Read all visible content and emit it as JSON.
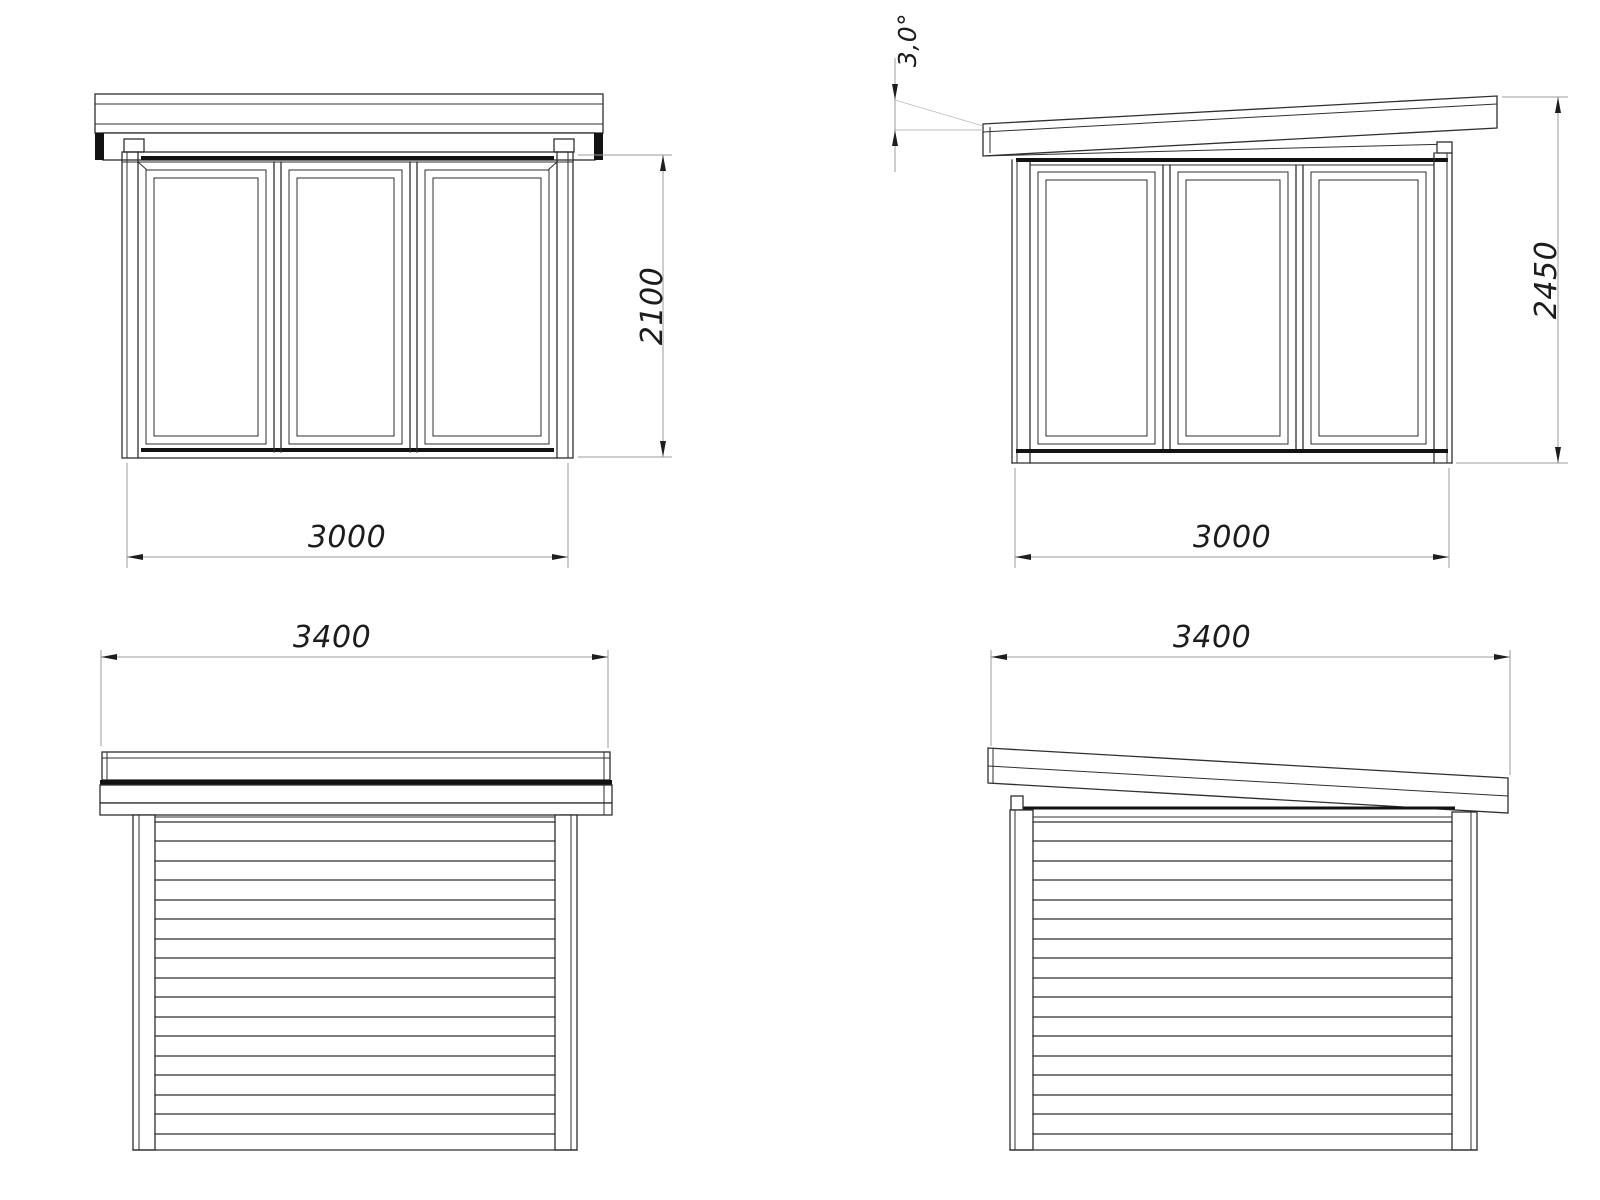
{
  "meta": {
    "background_color": "#ffffff",
    "line_color": "#2f2f2f",
    "heavy_line_color": "#121212",
    "dimension_line_color": "#9b9b9b",
    "dimension_text_color": "#1c1c1c"
  },
  "views": {
    "front_left": {
      "height_label": "2100",
      "width_label": "3000"
    },
    "front_right": {
      "angle_label": "3,0°",
      "height_label": "2450",
      "width_label": "3000"
    },
    "side_left": {
      "width_label": "3400"
    },
    "side_right": {
      "width_label": "3400"
    }
  }
}
